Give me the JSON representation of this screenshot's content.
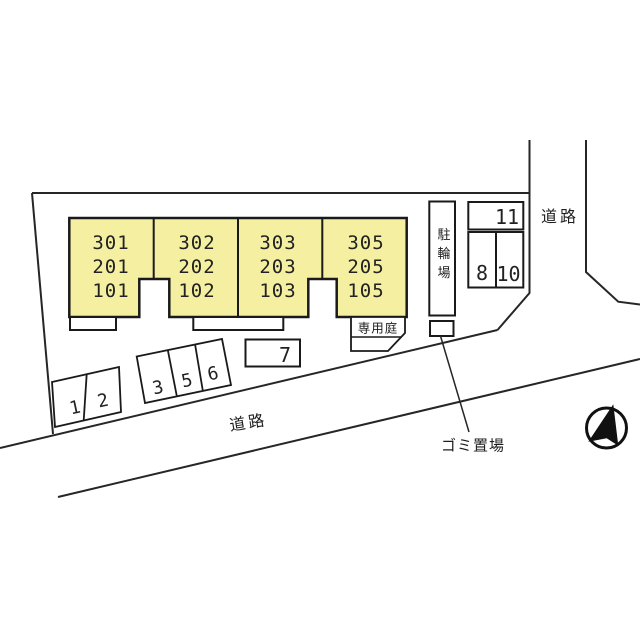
{
  "colors": {
    "building_fill": "#F5EFA1",
    "line": "#262626"
  },
  "building": {
    "units": [
      {
        "rooms": [
          "301",
          "201",
          "101"
        ]
      },
      {
        "rooms": [
          "302",
          "202",
          "102"
        ]
      },
      {
        "rooms": [
          "303",
          "203",
          "103"
        ]
      },
      {
        "rooms": [
          "305",
          "205",
          "105"
        ]
      }
    ]
  },
  "labels": {
    "bicycle_parking": "駐輪場",
    "private_garden": "専用庭",
    "garbage_area": "ゴミ置場",
    "road_right": "道路",
    "road_bottom": "道路"
  },
  "parking": {
    "spaces": [
      "1",
      "2",
      "3",
      "5",
      "6",
      "7",
      "8",
      "10",
      "11"
    ]
  }
}
